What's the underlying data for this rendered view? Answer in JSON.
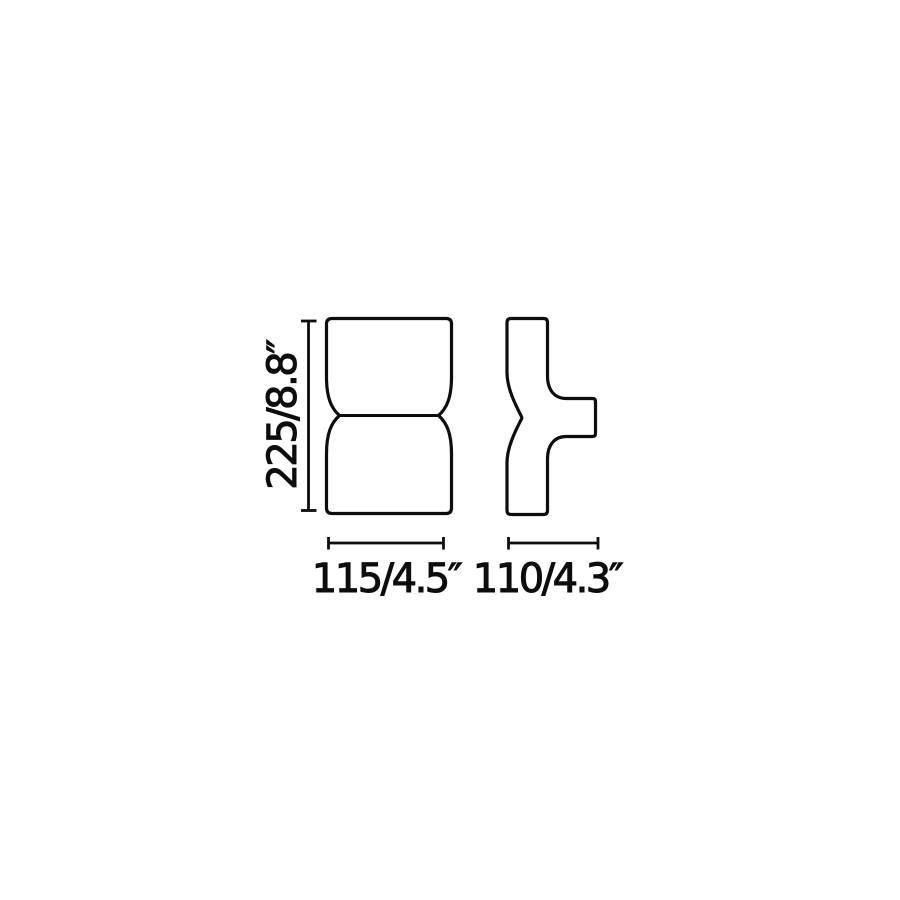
{
  "colors": {
    "background": "#ffffff",
    "line": "#0d0d0d"
  },
  "dimensions": {
    "height": {
      "label": "225/8.8″",
      "millimeters": "225",
      "inches": "8.8"
    },
    "front_width": {
      "label": "115/4.5″",
      "millimeters": "115",
      "inches": "4.5"
    },
    "side_depth": {
      "label": "110/4.3″",
      "millimeters": "110",
      "inches": "4.3"
    }
  }
}
